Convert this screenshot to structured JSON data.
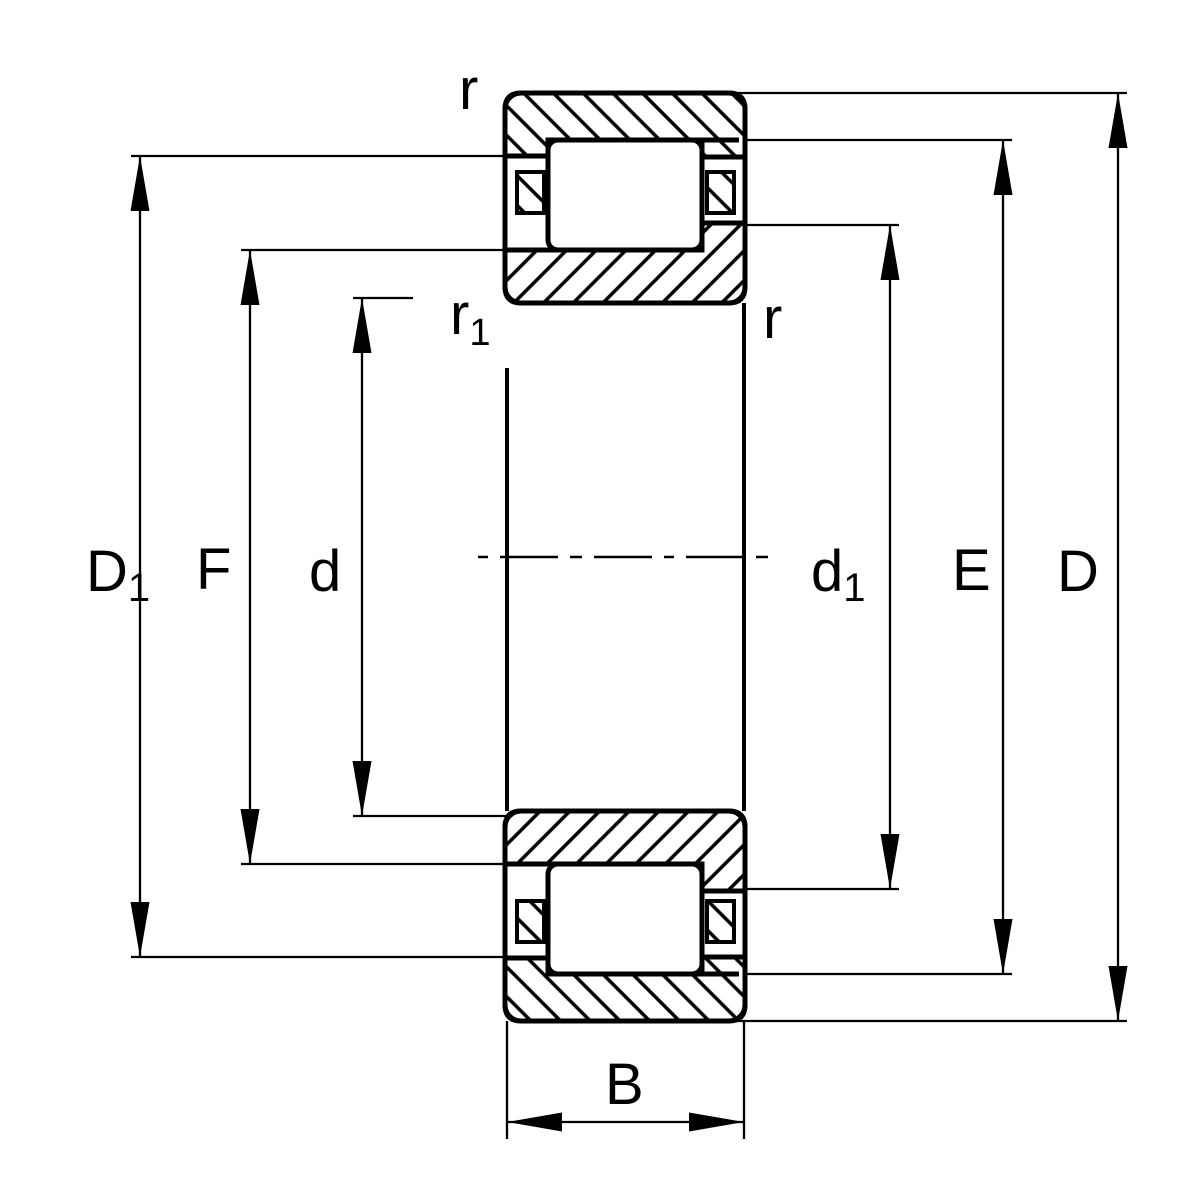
{
  "drawing": {
    "title": "cylindrical-roller-bearing-cross-section",
    "colors": {
      "line": "#000000",
      "background": "#ffffff"
    }
  },
  "labels": {
    "D1": {
      "base": "D",
      "sub": "1"
    },
    "F": "F",
    "d": "d",
    "d1": {
      "base": "d",
      "sub": "1"
    },
    "E": "E",
    "D": "D",
    "B": "B",
    "r_outer_top": "r",
    "r_outer_right": "r",
    "r1_inner": {
      "base": "r",
      "sub": "1"
    }
  }
}
